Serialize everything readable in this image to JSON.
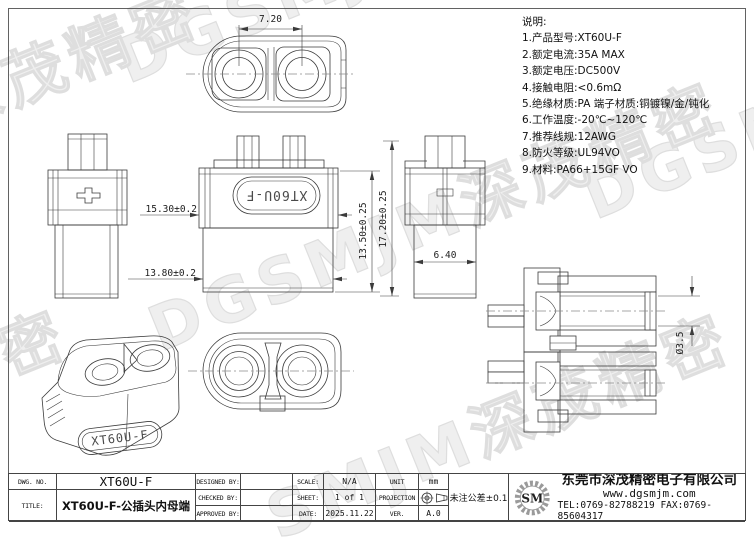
{
  "watermark": {
    "full": "DGSMJM深茂精密",
    "brand": "DGSMJM",
    "cn": "深茂精密",
    "cn_tail": "茂精密",
    "mixed": "SMJM深茂精密"
  },
  "part_label": "XT60U-F",
  "dimensions": {
    "pitch": "7.20",
    "upper_width": "15.30±0.2",
    "lower_width": "13.80±0.2",
    "body_height": "13.50±0.25",
    "total_height": "17.20±0.25",
    "side_width": "6.40",
    "bore_dia": "Ø3.5"
  },
  "notes": {
    "title": "说明:",
    "items": [
      "1.产品型号:XT60U-F",
      "2.额定电流:35A MAX",
      "3.额定电压:DC500V",
      "4.接触电阻:<0.6mΩ",
      "5.绝缘材质:PA 端子材质:铜镀镍/金/钝化",
      "6.工作温度:-20℃~120℃",
      "7.推荐线规:12AWG",
      "8.防火等级:UL94VO",
      "9.材料:PA66+15GF VO"
    ]
  },
  "title_block": {
    "dwg_no_label": "DWG. NO.",
    "dwg_no": "XT60U-F",
    "title_label": "TITLE:",
    "title": "XT60U-F-公插头内母端",
    "designed_by_label": "DESIGNED BY:",
    "designed_by": "",
    "checked_by_label": "CHECKED BY:",
    "checked_by": "",
    "approved_by_label": "APPROVED BY:",
    "approved_by": "",
    "scale_label": "SCALE:",
    "scale": "N/A",
    "sheet_label": "SHEET:",
    "sheet": "1 of 1",
    "date_label": "DATE:",
    "date": "2025.11.22",
    "unit_label": "UNIT",
    "unit": "mm",
    "projection_label": "PROJECTION",
    "ver_label": "VER.",
    "ver": "A.0",
    "tolerance": "未注公差±0.1",
    "company": {
      "logo": "SM",
      "name": "东莞市深茂精密电子有限公司",
      "website": "www.dgsmjm.com",
      "contact": "TEL:0769-82788219  FAX:0769-85604317"
    }
  }
}
